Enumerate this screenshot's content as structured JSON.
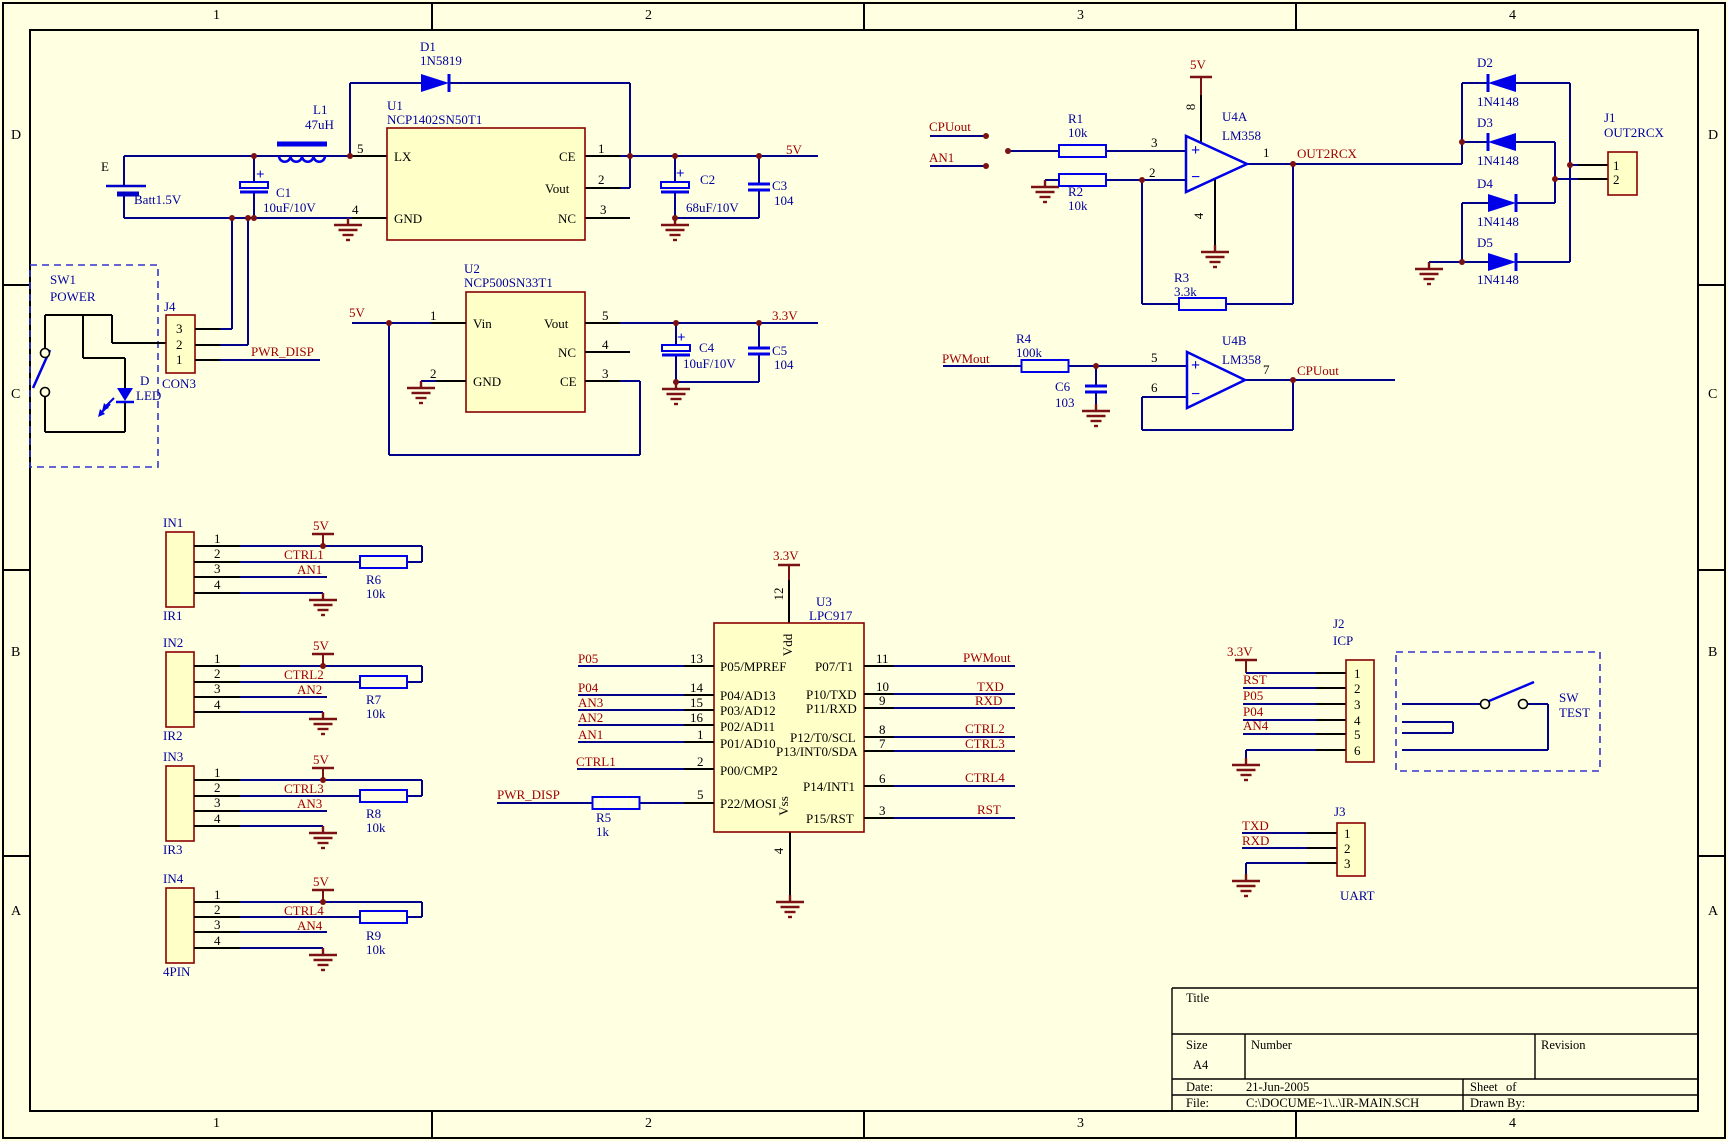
{
  "sheet": {
    "size": "A4",
    "zone_columns": [
      "1",
      "2",
      "3",
      "4"
    ],
    "zone_rows": [
      "D",
      "C",
      "B",
      "A"
    ],
    "background_color": "#FFFFE1",
    "wire_color": "#00008B",
    "symbol_color": "#0000E8",
    "net_label_color": "#A00000",
    "designator_color": "#0000A0",
    "power_symbol_color": "#7B1113",
    "component_fill": "#FFFFC8",
    "component_border": "#8B0000"
  },
  "title_block": {
    "title_label": "Title",
    "size_label": "Size",
    "size_value": "A4",
    "number_label": "Number",
    "revision_label": "Revision",
    "date_label": "Date:",
    "date_value": "21-Jun-2005",
    "sheet_label": "Sheet",
    "of_label": "of",
    "file_label": "File:",
    "file_value": "C:\\DOCUME~1\\..\\IR-MAIN.SCH",
    "drawn_label": "Drawn By:"
  },
  "labels": [
    {
      "t": "1",
      "x": 213,
      "y": 8,
      "c": "zone"
    },
    {
      "t": "2",
      "x": 645,
      "y": 8,
      "c": "zone"
    },
    {
      "t": "3",
      "x": 1077,
      "y": 8,
      "c": "zone"
    },
    {
      "t": "4",
      "x": 1509,
      "y": 8,
      "c": "zone"
    },
    {
      "t": "1",
      "x": 213,
      "y": 1116,
      "c": "zone"
    },
    {
      "t": "2",
      "x": 645,
      "y": 1116,
      "c": "zone"
    },
    {
      "t": "3",
      "x": 1077,
      "y": 1116,
      "c": "zone"
    },
    {
      "t": "4",
      "x": 1509,
      "y": 1116,
      "c": "zone"
    },
    {
      "t": "D",
      "x": 11,
      "y": 128,
      "c": "zone"
    },
    {
      "t": "C",
      "x": 11,
      "y": 387,
      "c": "zone"
    },
    {
      "t": "B",
      "x": 11,
      "y": 645,
      "c": "zone"
    },
    {
      "t": "A",
      "x": 11,
      "y": 904,
      "c": "zone"
    },
    {
      "t": "D",
      "x": 1708,
      "y": 128,
      "c": "zone"
    },
    {
      "t": "C",
      "x": 1708,
      "y": 387,
      "c": "zone"
    },
    {
      "t": "B",
      "x": 1708,
      "y": 645,
      "c": "zone"
    },
    {
      "t": "A",
      "x": 1708,
      "y": 904,
      "c": "zone"
    },
    {
      "t": "E",
      "x": 101,
      "y": 159,
      "c": "pin"
    },
    {
      "t": "Batt1.5V",
      "x": 134,
      "y": 192,
      "c": "des"
    },
    {
      "t": "L1",
      "x": 313,
      "y": 102,
      "c": "des"
    },
    {
      "t": "47uH",
      "x": 305,
      "y": 117,
      "c": "des"
    },
    {
      "t": "C1",
      "x": 276,
      "y": 185,
      "c": "des"
    },
    {
      "t": "10uF/10V",
      "x": 263,
      "y": 200,
      "c": "des"
    },
    {
      "t": "+",
      "x": 256,
      "y": 167,
      "c": "plus"
    },
    {
      "t": "D1",
      "x": 420,
      "y": 39,
      "c": "des"
    },
    {
      "t": "1N5819",
      "x": 420,
      "y": 53,
      "c": "des"
    },
    {
      "t": "U1",
      "x": 387,
      "y": 98,
      "c": "des"
    },
    {
      "t": "NCP1402SN50T1",
      "x": 387,
      "y": 112,
      "c": "des"
    },
    {
      "t": "5",
      "x": 357,
      "y": 141,
      "c": "pin"
    },
    {
      "t": "1",
      "x": 598,
      "y": 141,
      "c": "pin"
    },
    {
      "t": "2",
      "x": 598,
      "y": 172,
      "c": "pin"
    },
    {
      "t": "3",
      "x": 600,
      "y": 202,
      "c": "pin"
    },
    {
      "t": "4",
      "x": 352,
      "y": 202,
      "c": "pin"
    },
    {
      "t": "LX",
      "x": 394,
      "y": 149,
      "c": "pin"
    },
    {
      "t": "CE",
      "x": 559,
      "y": 149,
      "c": "pin"
    },
    {
      "t": "Vout",
      "x": 545,
      "y": 181,
      "c": "pin"
    },
    {
      "t": "GND",
      "x": 394,
      "y": 211,
      "c": "pin"
    },
    {
      "t": "NC",
      "x": 558,
      "y": 211,
      "c": "pin"
    },
    {
      "t": "+",
      "x": 676,
      "y": 166,
      "c": "plus"
    },
    {
      "t": "C2",
      "x": 700,
      "y": 172,
      "c": "des"
    },
    {
      "t": "68uF/10V",
      "x": 686,
      "y": 200,
      "c": "des"
    },
    {
      "t": "C3",
      "x": 772,
      "y": 178,
      "c": "des"
    },
    {
      "t": "104",
      "x": 774,
      "y": 193,
      "c": "des"
    },
    {
      "t": "5V",
      "x": 786,
      "y": 142,
      "c": "net"
    },
    {
      "t": "SW1",
      "x": 50,
      "y": 272,
      "c": "des"
    },
    {
      "t": "POWER",
      "x": 50,
      "y": 289,
      "c": "des"
    },
    {
      "t": "J4",
      "x": 164,
      "y": 299,
      "c": "des"
    },
    {
      "t": "3",
      "x": 176,
      "y": 321,
      "c": "pin"
    },
    {
      "t": "2",
      "x": 176,
      "y": 337,
      "c": "pin"
    },
    {
      "t": "1",
      "x": 176,
      "y": 352,
      "c": "pin"
    },
    {
      "t": "CON3",
      "x": 162,
      "y": 376,
      "c": "des"
    },
    {
      "t": "PWR_DISP",
      "x": 251,
      "y": 344,
      "c": "net"
    },
    {
      "t": "D",
      "x": 140,
      "y": 373,
      "c": "des"
    },
    {
      "t": "LED",
      "x": 136,
      "y": 388,
      "c": "des"
    },
    {
      "t": "U2",
      "x": 464,
      "y": 261,
      "c": "des"
    },
    {
      "t": "NCP500SN33T1",
      "x": 464,
      "y": 275,
      "c": "des"
    },
    {
      "t": "5V",
      "x": 349,
      "y": 305,
      "c": "net"
    },
    {
      "t": "1",
      "x": 430,
      "y": 308,
      "c": "pin"
    },
    {
      "t": "2",
      "x": 430,
      "y": 366,
      "c": "pin"
    },
    {
      "t": "5",
      "x": 602,
      "y": 308,
      "c": "pin"
    },
    {
      "t": "4",
      "x": 602,
      "y": 337,
      "c": "pin"
    },
    {
      "t": "3",
      "x": 602,
      "y": 366,
      "c": "pin"
    },
    {
      "t": "Vin",
      "x": 473,
      "y": 316,
      "c": "pin"
    },
    {
      "t": "GND",
      "x": 473,
      "y": 374,
      "c": "pin"
    },
    {
      "t": "Vout",
      "x": 544,
      "y": 316,
      "c": "pin"
    },
    {
      "t": "NC",
      "x": 558,
      "y": 345,
      "c": "pin"
    },
    {
      "t": "CE",
      "x": 560,
      "y": 374,
      "c": "pin"
    },
    {
      "t": "+",
      "x": 677,
      "y": 330,
      "c": "plus"
    },
    {
      "t": "C4",
      "x": 699,
      "y": 340,
      "c": "des"
    },
    {
      "t": "10uF/10V",
      "x": 683,
      "y": 356,
      "c": "des"
    },
    {
      "t": "C5",
      "x": 772,
      "y": 343,
      "c": "des"
    },
    {
      "t": "104",
      "x": 774,
      "y": 357,
      "c": "des"
    },
    {
      "t": "3.3V",
      "x": 772,
      "y": 308,
      "c": "net"
    },
    {
      "t": "CPUout",
      "x": 929,
      "y": 119,
      "c": "net"
    },
    {
      "t": "AN1",
      "x": 929,
      "y": 150,
      "c": "net"
    },
    {
      "t": "R1",
      "x": 1068,
      "y": 111,
      "c": "des"
    },
    {
      "t": "10k",
      "x": 1068,
      "y": 125,
      "c": "des"
    },
    {
      "t": "R2",
      "x": 1068,
      "y": 184,
      "c": "des"
    },
    {
      "t": "10k",
      "x": 1068,
      "y": 198,
      "c": "des"
    },
    {
      "t": "5V",
      "x": 1190,
      "y": 57,
      "c": "net"
    },
    {
      "t": "U4A",
      "x": 1222,
      "y": 109,
      "c": "des"
    },
    {
      "t": "LM358",
      "x": 1222,
      "y": 128,
      "c": "des"
    },
    {
      "t": "3",
      "x": 1151,
      "y": 135,
      "c": "pin"
    },
    {
      "t": "2",
      "x": 1149,
      "y": 165,
      "c": "pin"
    },
    {
      "t": "1",
      "x": 1263,
      "y": 145,
      "c": "pin"
    },
    {
      "t": "8",
      "x": 1191,
      "y": 107,
      "c": "pin",
      "r": 1
    },
    {
      "t": "4",
      "x": 1199,
      "y": 216,
      "c": "pin",
      "r": 1
    },
    {
      "t": "OUT2RCX",
      "x": 1297,
      "y": 146,
      "c": "net"
    },
    {
      "t": "R3",
      "x": 1174,
      "y": 270,
      "c": "des"
    },
    {
      "t": "3.3k",
      "x": 1174,
      "y": 284,
      "c": "des"
    },
    {
      "t": "+",
      "x": 1191,
      "y": 142,
      "c": "op"
    },
    {
      "t": "−",
      "x": 1191,
      "y": 169,
      "c": "op"
    },
    {
      "t": "D2",
      "x": 1477,
      "y": 55,
      "c": "des"
    },
    {
      "t": "1N4148",
      "x": 1477,
      "y": 94,
      "c": "des"
    },
    {
      "t": "D3",
      "x": 1477,
      "y": 115,
      "c": "des"
    },
    {
      "t": "1N4148",
      "x": 1477,
      "y": 153,
      "c": "des"
    },
    {
      "t": "D4",
      "x": 1477,
      "y": 176,
      "c": "des"
    },
    {
      "t": "1N4148",
      "x": 1477,
      "y": 214,
      "c": "des"
    },
    {
      "t": "D5",
      "x": 1477,
      "y": 235,
      "c": "des"
    },
    {
      "t": "1N4148",
      "x": 1477,
      "y": 272,
      "c": "des"
    },
    {
      "t": "J1",
      "x": 1604,
      "y": 110,
      "c": "des"
    },
    {
      "t": "OUT2RCX",
      "x": 1604,
      "y": 125,
      "c": "des"
    },
    {
      "t": "1",
      "x": 1613,
      "y": 158,
      "c": "pin"
    },
    {
      "t": "2",
      "x": 1613,
      "y": 172,
      "c": "pin"
    },
    {
      "t": "PWMout",
      "x": 942,
      "y": 351,
      "c": "net"
    },
    {
      "t": "R4",
      "x": 1016,
      "y": 331,
      "c": "des"
    },
    {
      "t": "100k",
      "x": 1016,
      "y": 345,
      "c": "des"
    },
    {
      "t": "C6",
      "x": 1055,
      "y": 379,
      "c": "des"
    },
    {
      "t": "103",
      "x": 1055,
      "y": 395,
      "c": "des"
    },
    {
      "t": "U4B",
      "x": 1222,
      "y": 333,
      "c": "des"
    },
    {
      "t": "LM358",
      "x": 1222,
      "y": 352,
      "c": "des"
    },
    {
      "t": "5",
      "x": 1151,
      "y": 350,
      "c": "pin"
    },
    {
      "t": "6",
      "x": 1151,
      "y": 380,
      "c": "pin"
    },
    {
      "t": "7",
      "x": 1263,
      "y": 362,
      "c": "pin"
    },
    {
      "t": "CPUout",
      "x": 1297,
      "y": 363,
      "c": "net"
    },
    {
      "t": "+",
      "x": 1191,
      "y": 357,
      "c": "op"
    },
    {
      "t": "−",
      "x": 1191,
      "y": 386,
      "c": "op"
    },
    {
      "t": "3.3V",
      "x": 773,
      "y": 548,
      "c": "net"
    },
    {
      "t": "12",
      "x": 779,
      "y": 594,
      "c": "pin",
      "r": 1
    },
    {
      "t": "U3",
      "x": 816,
      "y": 594,
      "c": "des"
    },
    {
      "t": "LPC917",
      "x": 809,
      "y": 608,
      "c": "des"
    },
    {
      "t": "Vdd",
      "x": 788,
      "y": 645,
      "c": "pin",
      "r": 1
    },
    {
      "t": "Vss",
      "x": 784,
      "y": 806,
      "c": "pin",
      "r": 1
    },
    {
      "t": "4",
      "x": 779,
      "y": 851,
      "c": "pin",
      "r": 1
    },
    {
      "t": "P05/MPREF",
      "x": 720,
      "y": 659,
      "c": "pin"
    },
    {
      "t": "P04/AD13",
      "x": 720,
      "y": 688,
      "c": "pin"
    },
    {
      "t": "P03/AD12",
      "x": 720,
      "y": 703,
      "c": "pin"
    },
    {
      "t": "P02/AD11",
      "x": 720,
      "y": 719,
      "c": "pin"
    },
    {
      "t": "P01/AD10",
      "x": 720,
      "y": 736,
      "c": "pin"
    },
    {
      "t": "P00/CMP2",
      "x": 720,
      "y": 763,
      "c": "pin"
    },
    {
      "t": "P22/MOSI",
      "x": 720,
      "y": 796,
      "c": "pin"
    },
    {
      "t": "P07/T1",
      "x": 815,
      "y": 659,
      "c": "pin"
    },
    {
      "t": "P10/TXD",
      "x": 806,
      "y": 687,
      "c": "pin"
    },
    {
      "t": "P11/RXD",
      "x": 806,
      "y": 701,
      "c": "pin"
    },
    {
      "t": "P12/T0/SCL",
      "x": 790,
      "y": 730,
      "c": "pin"
    },
    {
      "t": "P13/INT0/SDA",
      "x": 776,
      "y": 744,
      "c": "pin"
    },
    {
      "t": "P14/INT1",
      "x": 803,
      "y": 779,
      "c": "pin"
    },
    {
      "t": "P15/RST",
      "x": 806,
      "y": 811,
      "c": "pin"
    },
    {
      "t": "13",
      "x": 690,
      "y": 651,
      "c": "pin"
    },
    {
      "t": "14",
      "x": 690,
      "y": 680,
      "c": "pin"
    },
    {
      "t": "15",
      "x": 690,
      "y": 695,
      "c": "pin"
    },
    {
      "t": "16",
      "x": 690,
      "y": 710,
      "c": "pin"
    },
    {
      "t": "1",
      "x": 697,
      "y": 727,
      "c": "pin"
    },
    {
      "t": "2",
      "x": 697,
      "y": 754,
      "c": "pin"
    },
    {
      "t": "5",
      "x": 697,
      "y": 787,
      "c": "pin"
    },
    {
      "t": "11",
      "x": 876,
      "y": 651,
      "c": "pin"
    },
    {
      "t": "10",
      "x": 876,
      "y": 679,
      "c": "pin"
    },
    {
      "t": "9",
      "x": 879,
      "y": 693,
      "c": "pin"
    },
    {
      "t": "8",
      "x": 879,
      "y": 722,
      "c": "pin"
    },
    {
      "t": "7",
      "x": 879,
      "y": 736,
      "c": "pin"
    },
    {
      "t": "6",
      "x": 879,
      "y": 771,
      "c": "pin"
    },
    {
      "t": "3",
      "x": 879,
      "y": 803,
      "c": "pin"
    },
    {
      "t": "P05",
      "x": 578,
      "y": 651,
      "c": "net"
    },
    {
      "t": "P04",
      "x": 578,
      "y": 680,
      "c": "net"
    },
    {
      "t": "AN3",
      "x": 578,
      "y": 695,
      "c": "net"
    },
    {
      "t": "AN2",
      "x": 578,
      "y": 710,
      "c": "net"
    },
    {
      "t": "AN1",
      "x": 578,
      "y": 727,
      "c": "net"
    },
    {
      "t": "CTRL1",
      "x": 576,
      "y": 754,
      "c": "net"
    },
    {
      "t": "PWR_DISP",
      "x": 497,
      "y": 787,
      "c": "net"
    },
    {
      "t": "R5",
      "x": 596,
      "y": 810,
      "c": "des"
    },
    {
      "t": "1k",
      "x": 596,
      "y": 824,
      "c": "des"
    },
    {
      "t": "PWMout",
      "x": 963,
      "y": 650,
      "c": "net"
    },
    {
      "t": "TXD",
      "x": 977,
      "y": 679,
      "c": "net"
    },
    {
      "t": "RXD",
      "x": 975,
      "y": 693,
      "c": "net"
    },
    {
      "t": "CTRL2",
      "x": 965,
      "y": 721,
      "c": "net"
    },
    {
      "t": "CTRL3",
      "x": 965,
      "y": 736,
      "c": "net"
    },
    {
      "t": "CTRL4",
      "x": 965,
      "y": 770,
      "c": "net"
    },
    {
      "t": "RST",
      "x": 977,
      "y": 802,
      "c": "net"
    },
    {
      "t": "IN1",
      "x": 163,
      "y": 515,
      "c": "des"
    },
    {
      "t": "IR1",
      "x": 163,
      "y": 608,
      "c": "des"
    },
    {
      "t": "1",
      "x": 214,
      "y": 531,
      "c": "pin"
    },
    {
      "t": "2",
      "x": 214,
      "y": 546,
      "c": "pin"
    },
    {
      "t": "3",
      "x": 214,
      "y": 561,
      "c": "pin"
    },
    {
      "t": "4",
      "x": 214,
      "y": 577,
      "c": "pin"
    },
    {
      "t": "5V",
      "x": 313,
      "y": 518,
      "c": "net"
    },
    {
      "t": "CTRL1",
      "x": 284,
      "y": 547,
      "c": "net"
    },
    {
      "t": "AN1",
      "x": 297,
      "y": 562,
      "c": "net"
    },
    {
      "t": "R6",
      "x": 366,
      "y": 572,
      "c": "des"
    },
    {
      "t": "10k",
      "x": 366,
      "y": 586,
      "c": "des"
    },
    {
      "t": "IN2",
      "x": 163,
      "y": 635,
      "c": "des"
    },
    {
      "t": "IR2",
      "x": 163,
      "y": 728,
      "c": "des"
    },
    {
      "t": "1",
      "x": 214,
      "y": 651,
      "c": "pin"
    },
    {
      "t": "2",
      "x": 214,
      "y": 666,
      "c": "pin"
    },
    {
      "t": "3",
      "x": 214,
      "y": 681,
      "c": "pin"
    },
    {
      "t": "4",
      "x": 214,
      "y": 697,
      "c": "pin"
    },
    {
      "t": "5V",
      "x": 313,
      "y": 638,
      "c": "net"
    },
    {
      "t": "CTRL2",
      "x": 284,
      "y": 667,
      "c": "net"
    },
    {
      "t": "AN2",
      "x": 297,
      "y": 682,
      "c": "net"
    },
    {
      "t": "R7",
      "x": 366,
      "y": 692,
      "c": "des"
    },
    {
      "t": "10k",
      "x": 366,
      "y": 706,
      "c": "des"
    },
    {
      "t": "IN3",
      "x": 163,
      "y": 749,
      "c": "des"
    },
    {
      "t": "IR3",
      "x": 163,
      "y": 842,
      "c": "des"
    },
    {
      "t": "1",
      "x": 214,
      "y": 765,
      "c": "pin"
    },
    {
      "t": "2",
      "x": 214,
      "y": 780,
      "c": "pin"
    },
    {
      "t": "3",
      "x": 214,
      "y": 795,
      "c": "pin"
    },
    {
      "t": "4",
      "x": 214,
      "y": 811,
      "c": "pin"
    },
    {
      "t": "5V",
      "x": 313,
      "y": 752,
      "c": "net"
    },
    {
      "t": "CTRL3",
      "x": 284,
      "y": 781,
      "c": "net"
    },
    {
      "t": "AN3",
      "x": 297,
      "y": 796,
      "c": "net"
    },
    {
      "t": "R8",
      "x": 366,
      "y": 806,
      "c": "des"
    },
    {
      "t": "10k",
      "x": 366,
      "y": 820,
      "c": "des"
    },
    {
      "t": "IN4",
      "x": 163,
      "y": 871,
      "c": "des"
    },
    {
      "t": "4PIN",
      "x": 163,
      "y": 964,
      "c": "des"
    },
    {
      "t": "1",
      "x": 214,
      "y": 887,
      "c": "pin"
    },
    {
      "t": "2",
      "x": 214,
      "y": 902,
      "c": "pin"
    },
    {
      "t": "3",
      "x": 214,
      "y": 917,
      "c": "pin"
    },
    {
      "t": "4",
      "x": 214,
      "y": 933,
      "c": "pin"
    },
    {
      "t": "5V",
      "x": 313,
      "y": 874,
      "c": "net"
    },
    {
      "t": "CTRL4",
      "x": 284,
      "y": 903,
      "c": "net"
    },
    {
      "t": "AN4",
      "x": 297,
      "y": 918,
      "c": "net"
    },
    {
      "t": "R9",
      "x": 366,
      "y": 928,
      "c": "des"
    },
    {
      "t": "10k",
      "x": 366,
      "y": 942,
      "c": "des"
    },
    {
      "t": "J2",
      "x": 1333,
      "y": 616,
      "c": "des"
    },
    {
      "t": "ICP",
      "x": 1333,
      "y": 633,
      "c": "des"
    },
    {
      "t": "3.3V",
      "x": 1227,
      "y": 644,
      "c": "net"
    },
    {
      "t": "RST",
      "x": 1243,
      "y": 672,
      "c": "net"
    },
    {
      "t": "P05",
      "x": 1243,
      "y": 688,
      "c": "net"
    },
    {
      "t": "P04",
      "x": 1243,
      "y": 704,
      "c": "net"
    },
    {
      "t": "AN4",
      "x": 1243,
      "y": 718,
      "c": "net"
    },
    {
      "t": "1",
      "x": 1354,
      "y": 666,
      "c": "pin"
    },
    {
      "t": "2",
      "x": 1354,
      "y": 681,
      "c": "pin"
    },
    {
      "t": "3",
      "x": 1354,
      "y": 697,
      "c": "pin"
    },
    {
      "t": "4",
      "x": 1354,
      "y": 713,
      "c": "pin"
    },
    {
      "t": "5",
      "x": 1354,
      "y": 727,
      "c": "pin"
    },
    {
      "t": "6",
      "x": 1354,
      "y": 743,
      "c": "pin"
    },
    {
      "t": "SW",
      "x": 1559,
      "y": 690,
      "c": "des"
    },
    {
      "t": "TEST",
      "x": 1559,
      "y": 705,
      "c": "des"
    },
    {
      "t": "J3",
      "x": 1334,
      "y": 804,
      "c": "des"
    },
    {
      "t": "TXD",
      "x": 1242,
      "y": 818,
      "c": "net"
    },
    {
      "t": "RXD",
      "x": 1242,
      "y": 833,
      "c": "net"
    },
    {
      "t": "1",
      "x": 1344,
      "y": 826,
      "c": "pin"
    },
    {
      "t": "2",
      "x": 1344,
      "y": 841,
      "c": "pin"
    },
    {
      "t": "3",
      "x": 1344,
      "y": 856,
      "c": "pin"
    },
    {
      "t": "UART",
      "x": 1340,
      "y": 888,
      "c": "des"
    }
  ]
}
